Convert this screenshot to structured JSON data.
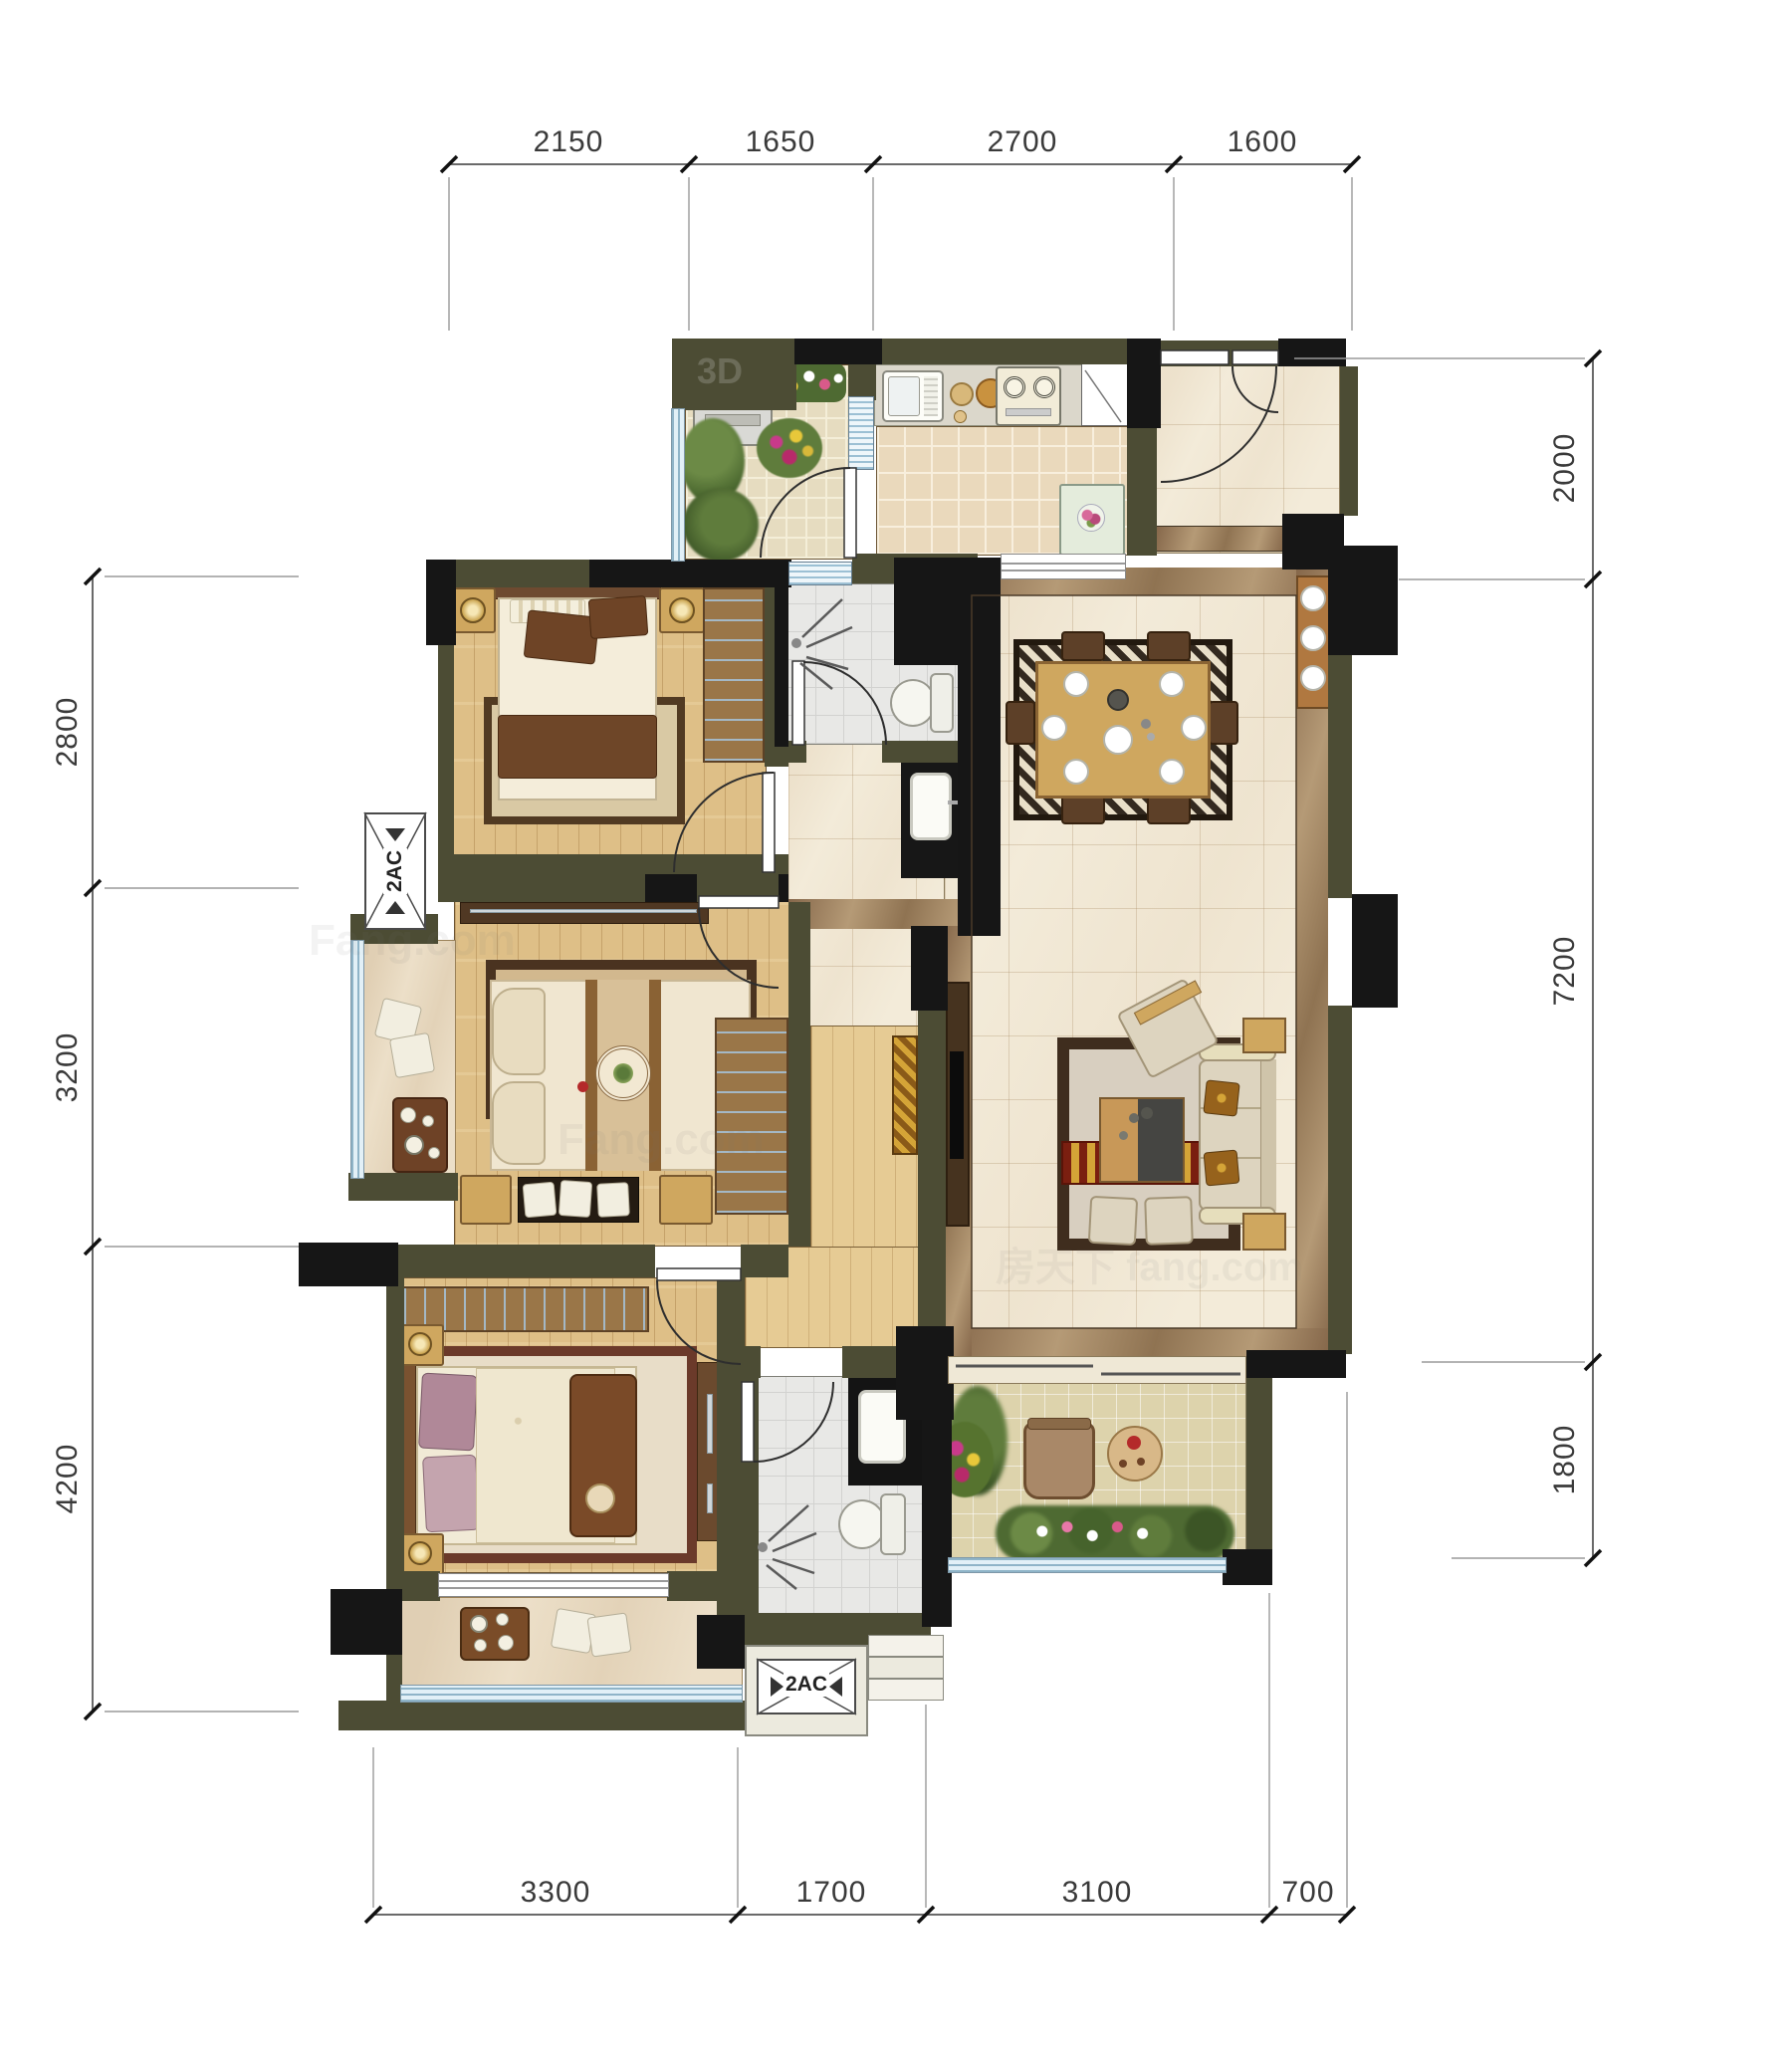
{
  "document": {
    "type": "residential-floor-plan",
    "units": "mm",
    "style": "rendered color floor plan with CAD dimension chains"
  },
  "dimensions": {
    "top": [
      "2150",
      "1650",
      "2700",
      "1600"
    ],
    "bottom": [
      "3300",
      "1700",
      "3100",
      "700"
    ],
    "left": [
      "2800",
      "3200",
      "4200"
    ],
    "right": [
      "2000",
      "7200",
      "1800"
    ]
  },
  "annotations": {
    "ac_platform_labels": [
      "2AC",
      "2AC"
    ]
  },
  "watermarks": [
    "3D",
    "Fang.com",
    "房天下 fang.com",
    "Fang.com"
  ],
  "colors": {
    "wall": "#4c4c34",
    "column": "#161616",
    "wood_floor": "#debf87",
    "kitchen_tile": "#ead9bc",
    "marble_floor": "#f3ebd9",
    "marble_border": "#8f7352",
    "bath_tile": "#e8e8e6",
    "balcony_paving": "#ddd3ac",
    "greenery": "#5f7c3c",
    "rug_border": "#3f2d1e",
    "dimension_line": "#6a6a6a",
    "dimension_text": "#3a3a3a"
  },
  "icons": [
    "washing-machine-icon",
    "plant-icon",
    "flower-bed-icon",
    "kitchen-sink-icon",
    "cutting-board-icon",
    "gas-stove-icon",
    "window-icon",
    "fridge-icon",
    "door-swing-icon",
    "double-door-icon",
    "dining-table-icon",
    "dining-chair-icon",
    "plate-icon",
    "teapot-icon",
    "sideboard-icon",
    "toilet-icon",
    "shower-head-icon",
    "vanity-sink-icon",
    "double-bed-icon",
    "pillow-icon",
    "nightstand-icon",
    "table-lamp-icon",
    "wardrobe-icon",
    "rug-icon",
    "tv-cabinet-icon",
    "tv-icon",
    "sofa-icon",
    "armchair-icon",
    "coffee-table-icon",
    "ottoman-icon",
    "side-table-icon",
    "balcony-chair-icon",
    "round-table-icon",
    "tea-table-icon",
    "cushion-icon",
    "tea-tray-icon",
    "bench-icon",
    "sliding-door-icon",
    "railing-icon",
    "steps-icon",
    "ac-platform-icon",
    "dimension-tick-icon"
  ]
}
